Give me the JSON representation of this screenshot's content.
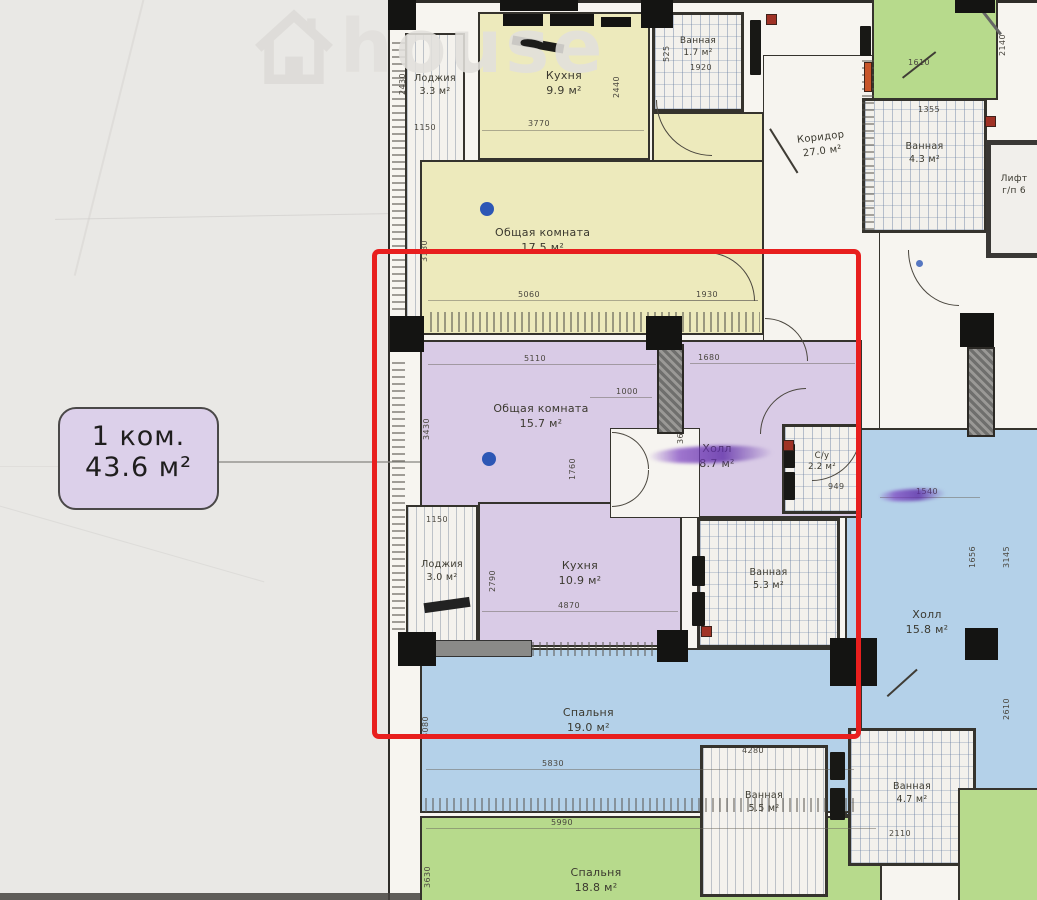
{
  "watermark": {
    "text": "house",
    "icon": "house-icon"
  },
  "tag": {
    "type": "1 ком.",
    "area": "43.6 м²"
  },
  "rooms": [
    {
      "name": "Лоджия",
      "area": "3.3 м²"
    },
    {
      "name": "Кухня",
      "area": "9.9 м²"
    },
    {
      "name": "Ванная",
      "area": "1.7 м²"
    },
    {
      "name": "Холл",
      "area": "8.8 м²"
    },
    {
      "name": "Общая комната",
      "area": "17.5 м²"
    },
    {
      "name": "Общая комната",
      "area": "15.7 м²"
    },
    {
      "name": "Холл",
      "area": "8.7 м²"
    },
    {
      "name": "С/у",
      "area": "2.2 м²"
    },
    {
      "name": "Лоджия",
      "area": "3.0 м²"
    },
    {
      "name": "Кухня",
      "area": "10.9 м²"
    },
    {
      "name": "Ванная",
      "area": "5.3 м²"
    },
    {
      "name": "Спальня",
      "area": "19.0 м²"
    },
    {
      "name": "Спальня",
      "area": "18.8 м²"
    },
    {
      "name": "Коридор",
      "area": "27.0 м²"
    },
    {
      "name": "Ванная",
      "area": "4.3 м²"
    },
    {
      "name": "Лифт",
      "area": "г/п 6"
    },
    {
      "name": "Холл",
      "area": "15.8 м²"
    },
    {
      "name": "Ванная",
      "area": "5.5 м²"
    },
    {
      "name": "Ванная",
      "area": "4.7 м²"
    }
  ],
  "dims": [
    "2430",
    "1150",
    "3770",
    "2440",
    "525",
    "1920",
    "1610",
    "2140",
    "1355",
    "5060",
    "1930",
    "3180",
    "5110",
    "1680",
    "1000",
    "3430",
    "3640",
    "1760",
    "949",
    "1540",
    "3145",
    "1150",
    "2790",
    "4870",
    "5830",
    "3080",
    "1656",
    "2610",
    "5990",
    "3630",
    "4280",
    "2110"
  ],
  "colors": {
    "highlight_red": "#e81f1e",
    "room_yellow": "#edeabc",
    "room_purple": "#d9cbe6",
    "room_blue": "#b4d1e9",
    "room_green": "#b7da8c",
    "tag_purple": "#dcd0ea",
    "marker_purple": "#7a3fc0",
    "dot_blue": "#2d57b5",
    "wall_dark": "#2e2c28"
  }
}
